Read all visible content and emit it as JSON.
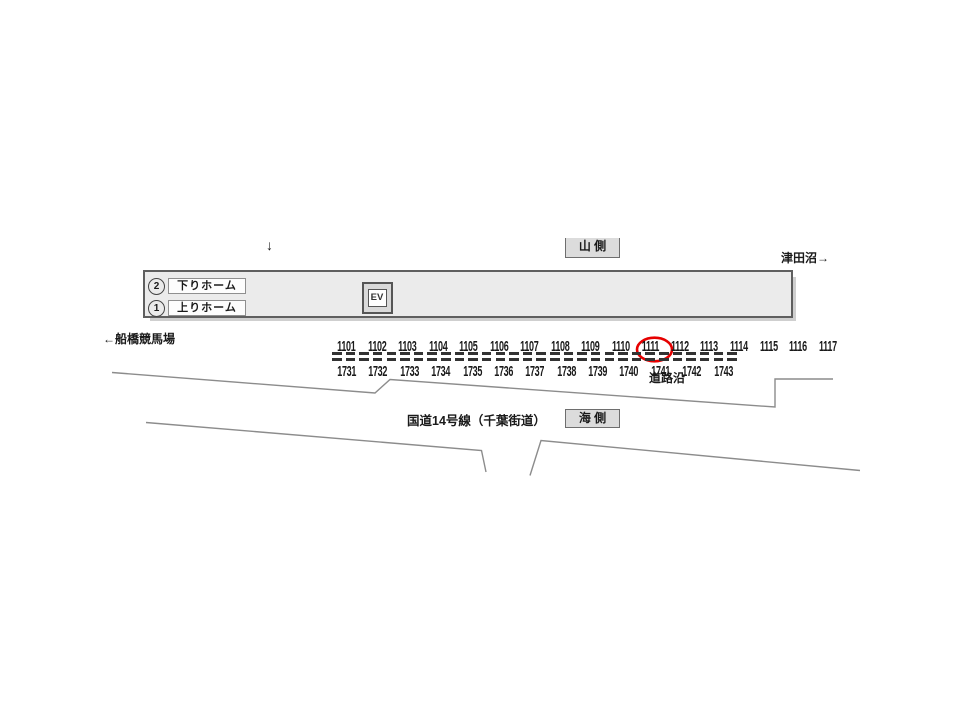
{
  "labels": {
    "mountain_side": "山 側",
    "sea_side": "海 側",
    "next_station_right": "津田沼→",
    "next_station_left": "←船橋競馬場",
    "road_name": "国道14号線（千葉街道）",
    "roadside": "道路沿",
    "small_down_arrow": "↓"
  },
  "platform": {
    "platform2_number": "2",
    "platform2_label": "下りホーム",
    "platform1_number": "1",
    "platform1_label": "上りホーム",
    "elevator_label": "EV"
  },
  "board_numbers": {
    "top_row": [
      "1101",
      "1102",
      "1103",
      "1104",
      "1105",
      "1106",
      "1107",
      "1108",
      "1109",
      "1110",
      "1111",
      "1112",
      "1113",
      "1114",
      "1115",
      "1116",
      "1117"
    ],
    "bottom_row": [
      "1731",
      "1732",
      "1733",
      "1734",
      "1735",
      "1736",
      "1737",
      "1738",
      "1739",
      "1740",
      "1741",
      "1742",
      "1743"
    ]
  },
  "highlight": {
    "circled_number": "1114"
  },
  "colors": {
    "highlight_red": "#e60000",
    "platform_fill": "#ebebeb",
    "road_line_gray": "#8c8c8c",
    "side_box_fill": "#dcdcdc",
    "dash_color": "#333333"
  }
}
